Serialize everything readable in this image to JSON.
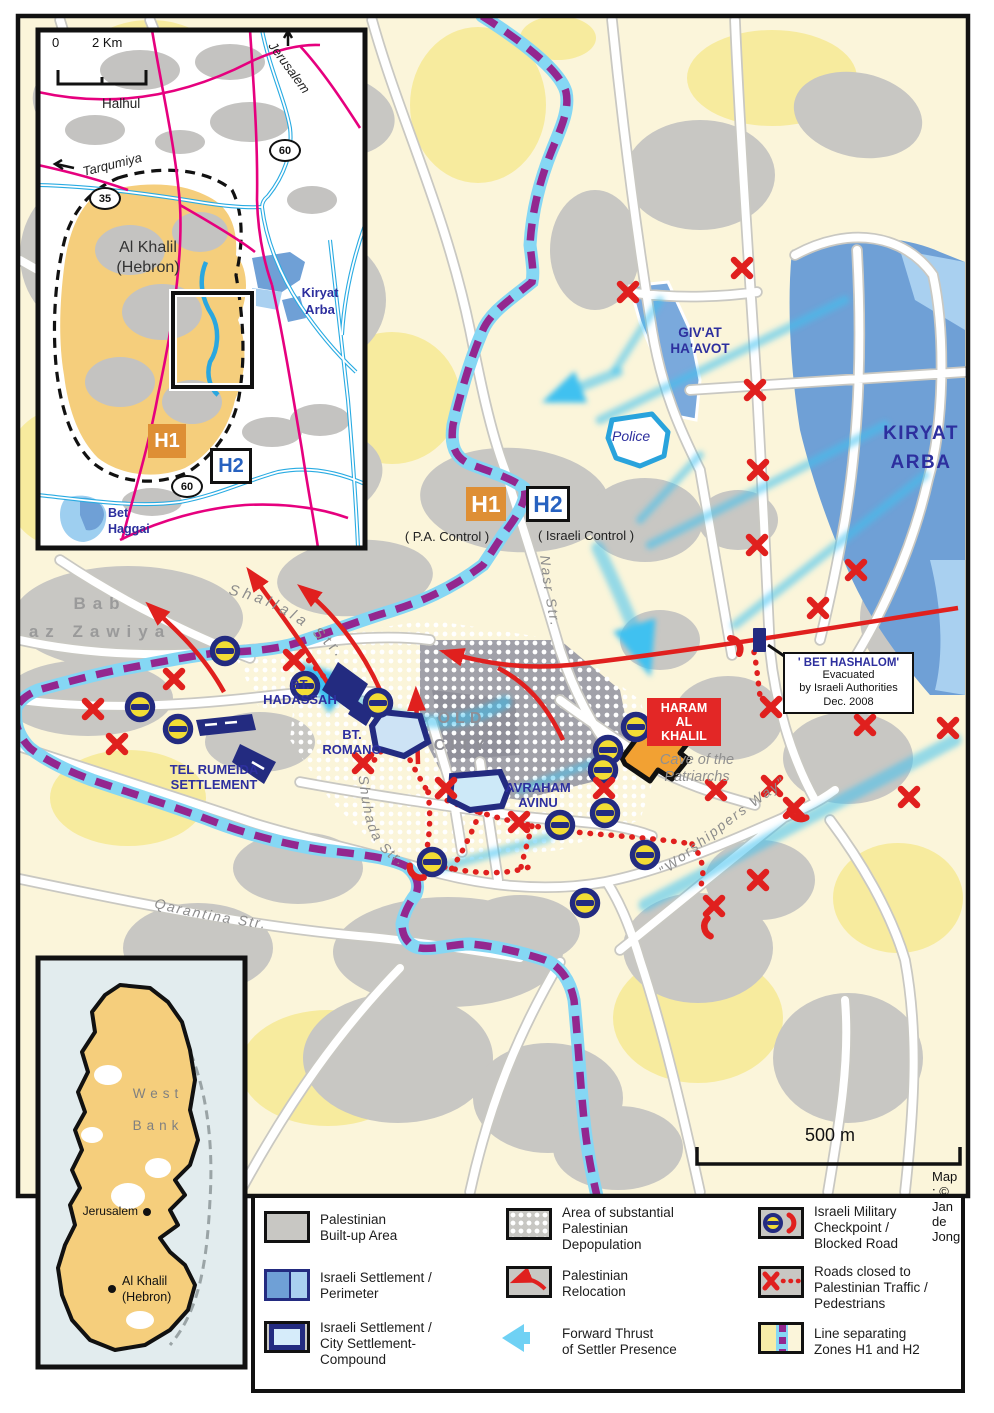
{
  "region_inset": {
    "scale_zero": "0",
    "scale_km": "2 Km",
    "halhul": "Halhul",
    "jerusalem_dir": "Jerusalem",
    "tarqumiya_dir": "Tarqumiya",
    "route_35": "35",
    "route_60": "60",
    "route_60b": "60",
    "al_khalil": "Al Khalil\n(Hebron)",
    "kiryat_arba": "Kiryat\nArba",
    "h1": "H1",
    "h2": "H2",
    "bet_haggai": "Bet\nHaggai"
  },
  "main": {
    "h1_badge": "H1",
    "h1_sub": "( P.A. Control )",
    "h2_badge": "H2",
    "h2_sub": "( Israeli Control )",
    "police": "Police",
    "givat_haavot": "GIV'AT\nHA'AVOT",
    "kiryat_arba": "KIRYAT\nARBA",
    "bab_az_zawiya": "Bab\naz Zawiya",
    "bt_hadassah": "BT.\nHADASSAH",
    "bt_romano": "BT.\nROMANO",
    "tel_rumeida": "TEL RUMEIDA\nSETTLEMENT",
    "old_city": "OLD\nCITY",
    "avraham_avinu": "AVRAHAM\nAVINU",
    "haram_al_khalil": "HARAM\nAL\nKHALIL",
    "cave": "Cave of the\nPatriarchs",
    "bet_hashalom_title": "' BET HASHALOM'",
    "bet_hashalom_body": "Evacuated\nby Israeli Authorities\nDec. 2008",
    "streets": {
      "shallala": "Shallala Str.",
      "shuhada": "Shuhada Str.",
      "qarantina": "Qarantina Str.",
      "nasr": "Nasr Str.",
      "worshippers": "\"Worshippers Way\""
    },
    "scale_label": "500 m",
    "credit": "Map : © Jan de Jong"
  },
  "westbank_inset": {
    "west_bank": "West\nBank",
    "jerusalem": "Jerusalem",
    "al_khalil": "Al Khalil\n(Hebron)"
  },
  "legend": {
    "items": [
      {
        "label": "Palestinian\nBuilt-up Area"
      },
      {
        "label": "Israeli Settlement /\nPerimeter"
      },
      {
        "label": "Israeli Settlement /\nCity Settlement-\nCompound"
      },
      {
        "label": "Area of substantial\nPalestinian\nDepopulation"
      },
      {
        "label": "Palestinian\nRelocation"
      },
      {
        "label": "Forward Thrust\nof Settler Presence"
      },
      {
        "label": "Israeli Military\nCheckpoint /\nBlocked Road"
      },
      {
        "label": "Roads closed to\nPalestinian Traffic /\nPedestrians"
      },
      {
        "label": "Line separating\nZones H1 and H2"
      }
    ]
  },
  "colors": {
    "builtup_gray": "#C8C7C3",
    "old_city_gray": "#A1A1A9",
    "settlement_blue": "#6FA0D6",
    "settlement_light_blue": "#A9D0F0",
    "navy": "#232B80",
    "zone_band_cyan": "#85D7F4",
    "zone_dash_purple": "#93278F",
    "closed_red": "#E0201E",
    "h1_orange": "#DE8F35",
    "haram_red": "#E32726",
    "inset_road_magenta": "#E6007E",
    "cream": "#FBF5DA",
    "yellow": "#F7EB9E",
    "tan": "#F5CE7C"
  }
}
